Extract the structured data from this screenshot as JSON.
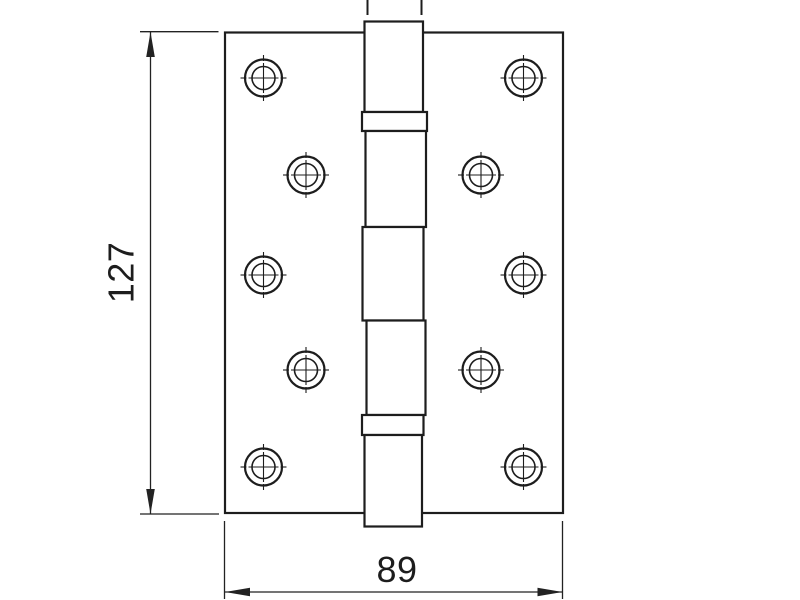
{
  "drawing": {
    "type": "technical-drawing",
    "subject": "butt-hinge-front-view",
    "background": "#ffffff",
    "stroke_color": "#1d1d1d",
    "dim_color": "#222222",
    "leaves": [
      {
        "x": 225,
        "y": 32.5,
        "w": 169,
        "h": 480.5
      },
      {
        "x": 394,
        "y": 32.5,
        "w": 169,
        "h": 480.5
      }
    ],
    "barrel_segments": [
      {
        "x": 364.5,
        "y": 21.5,
        "w": 58.5,
        "h": 90.5
      },
      {
        "x": 362,
        "y": 112,
        "w": 65,
        "h": 19
      },
      {
        "x": 365.5,
        "y": 131,
        "w": 60.5,
        "h": 96
      },
      {
        "x": 362.5,
        "y": 227,
        "w": 61,
        "h": 93.5
      },
      {
        "x": 366.5,
        "y": 320.5,
        "w": 59,
        "h": 94.5
      },
      {
        "x": 362,
        "y": 415,
        "w": 61.5,
        "h": 20
      },
      {
        "x": 364.5,
        "y": 435,
        "w": 57.5,
        "h": 91.5
      }
    ],
    "pin_stubs": [
      {
        "x": 367.5,
        "y1": 0,
        "y2": 15
      },
      {
        "x": 421.5,
        "y1": 0,
        "y2": 15
      }
    ],
    "holes": {
      "outer_r": 18.5,
      "inner_r": 11.5,
      "cross_half": 15,
      "tick_inner": 17,
      "tick_outer": 23,
      "centers": [
        [
          263.5,
          78
        ],
        [
          306,
          175
        ],
        [
          263.5,
          275
        ],
        [
          306,
          370
        ],
        [
          263.5,
          467
        ],
        [
          523.5,
          78
        ],
        [
          481,
          175
        ],
        [
          523.5,
          275
        ],
        [
          481,
          370
        ],
        [
          523.5,
          467
        ]
      ]
    },
    "dimensions": {
      "arrow": {
        "length": 25,
        "half_width": 4.3
      },
      "vertical": {
        "label": "127",
        "value": 127,
        "line": {
          "x1": 150.5,
          "y1": 32,
          "x2": 150.5,
          "y2": 514
        },
        "ext_lines": [
          {
            "x1": 140,
            "y1": 31.7,
            "x2": 218.5,
            "y2": 31.7
          },
          {
            "x1": 140,
            "y1": 514,
            "x2": 219,
            "y2": 514
          }
        ],
        "arrows": [
          {
            "tip": [
              150.5,
              32
            ],
            "dir": "up"
          },
          {
            "tip": [
              150.5,
              514
            ],
            "dir": "down"
          }
        ]
      },
      "horizontal": {
        "label": "89",
        "value": 89,
        "line": {
          "x1": 225,
          "y1": 592,
          "x2": 562.5,
          "y2": 592
        },
        "ext_lines": [
          {
            "x1": 224.5,
            "y1": 521,
            "x2": 224.5,
            "y2": 599
          },
          {
            "x1": 562.5,
            "y1": 521,
            "x2": 562.5,
            "y2": 599
          }
        ],
        "arrows": [
          {
            "tip": [
              225,
              592
            ],
            "dir": "left"
          },
          {
            "tip": [
              562.5,
              592
            ],
            "dir": "right"
          }
        ]
      }
    }
  }
}
